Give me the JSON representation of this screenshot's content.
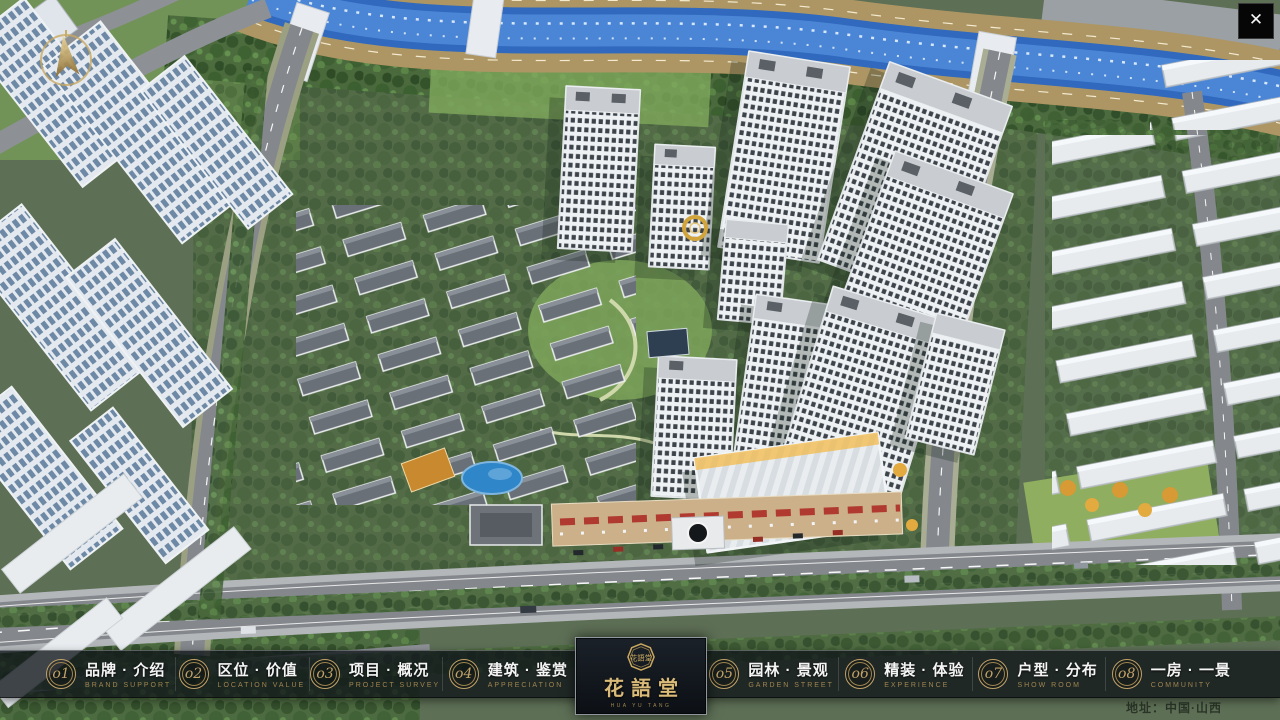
{
  "colors": {
    "gold": "#c2a269",
    "gold_dim": "#9f854f",
    "nav_bg": "rgba(16,20,25,0.78)"
  },
  "overlay": {
    "close_icon": "✕",
    "address": "地址：中国·山西"
  },
  "logo": {
    "cn": "花語堂",
    "en": "HUA YU TANG",
    "seal": "花語堂"
  },
  "nav": {
    "items": [
      {
        "num": "o1",
        "cn": "品牌 · 介绍",
        "en": "BRAND SUPPORT"
      },
      {
        "num": "o2",
        "cn": "区位 · 价值",
        "en": "LOCATION VALUE"
      },
      {
        "num": "o3",
        "cn": "项目 · 概况",
        "en": "PROJECT SURVEY"
      },
      {
        "num": "o4",
        "cn": "建筑 · 鉴赏",
        "en": "APPRECIATION"
      },
      {
        "num": "o5",
        "cn": "园林 · 景观",
        "en": "GARDEN STREET"
      },
      {
        "num": "o6",
        "cn": "精装 · 体验",
        "en": "EXPERIENCE"
      },
      {
        "num": "o7",
        "cn": "户型 · 分布",
        "en": "SHOW ROOM"
      },
      {
        "num": "o8",
        "cn": "一房 · 一景",
        "en": "COMMUNITY"
      }
    ]
  }
}
